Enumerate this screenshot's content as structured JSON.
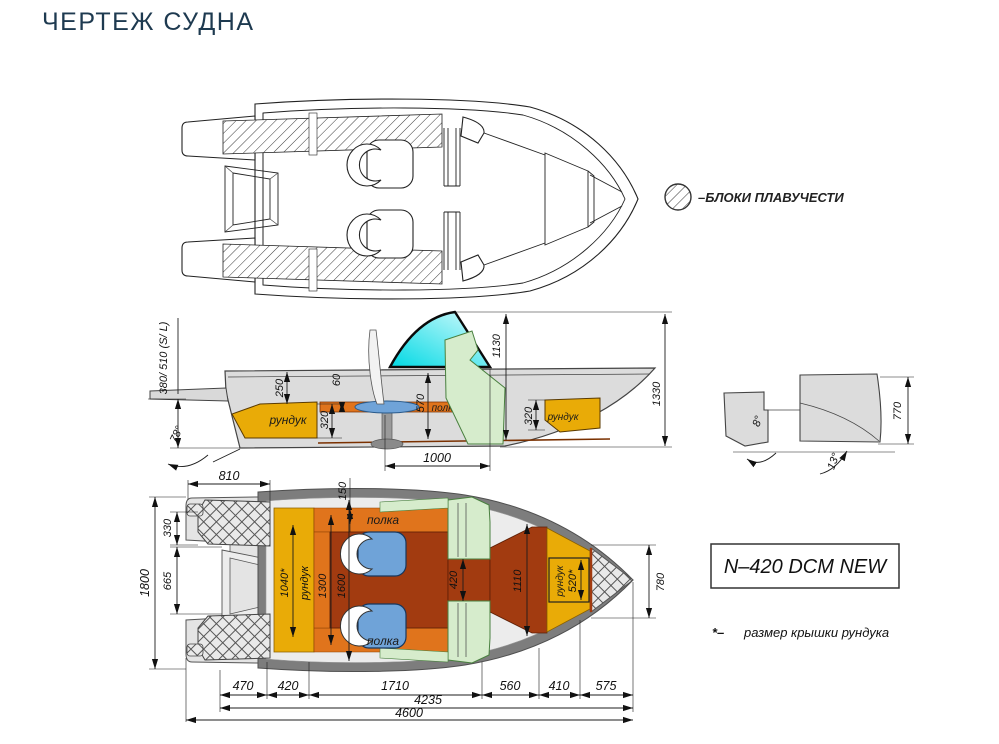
{
  "title": "ЧЕРТЕЖ СУДНА",
  "legend": {
    "label": "–БЛОКИ ПЛАВУЧЕСТИ"
  },
  "model_box": {
    "label": "N–420 DCM NEW"
  },
  "footnote": {
    "marker": "*–",
    "text": "размер крышки рундука"
  },
  "colors": {
    "title_navy": "#1e3a50",
    "hull_gray": "#dcdcdc",
    "gunwale_gray": "#7d7d7d",
    "inner_gray": "#ececec",
    "locker_yellow": "#e9ab07",
    "shelf_orange": "#e0741c",
    "floor_red": "#a23b10",
    "seat_blue": "#6fa3d8",
    "console_green": "#d6eccc",
    "windshield_cyan": "#00d9e4"
  },
  "side_view": {
    "locker_left": "рундук",
    "locker_right": "рундук",
    "shelf": "полка",
    "dims": {
      "mirror_height": "380/ 510 (S/ L)",
      "transom_angle": "78°",
      "step_h": "250",
      "shelf_gap": "60",
      "locker_left_h": "320",
      "cockpit_h": "570",
      "windshield_h": "1130",
      "overall_h": "1330",
      "locker_right_h": "320",
      "table_zone_len": "1000"
    }
  },
  "transom_view": {
    "dims": {
      "transom_h": "770",
      "angle_outer": "8°",
      "angle_keel": "13°"
    }
  },
  "plan_view": {
    "shelf_top": "полка",
    "shelf_bottom": "полка",
    "locker_stern": "рундук",
    "locker_bow": "рундук",
    "dims": {
      "stern_block_w": "810",
      "shelf_w": "150",
      "block_h": "330",
      "well_h": "665",
      "beam": "1800",
      "stern_lid": "1040*",
      "floor_w": "1300",
      "cockpit_w": "1600",
      "console_gap": "420",
      "bow_cockpit_w": "1110",
      "bow_lid": "520*",
      "bow_block_w": "780",
      "seg_1": "470",
      "seg_2": "420",
      "seg_3": "1710",
      "seg_4": "560",
      "seg_5": "410",
      "seg_6": "575",
      "len_cockpit_total": "4235",
      "len_overall": "4600"
    }
  }
}
